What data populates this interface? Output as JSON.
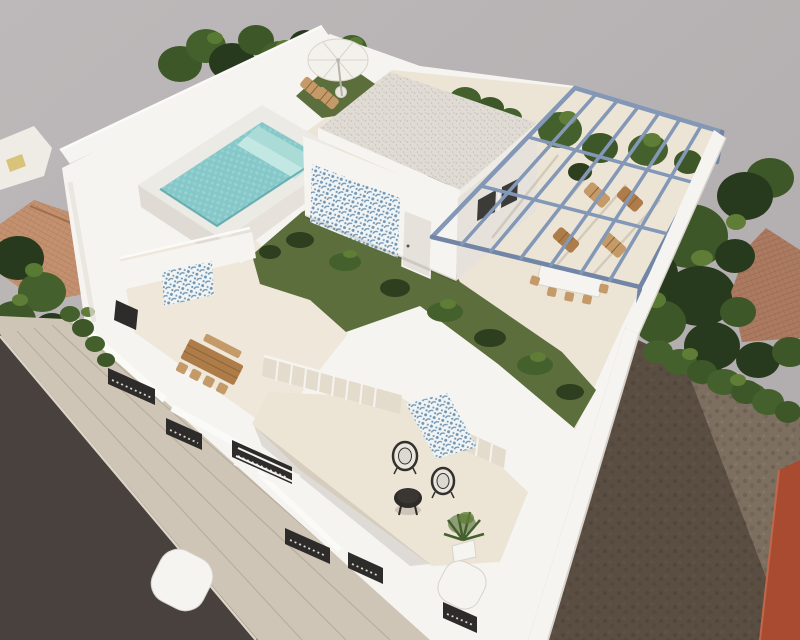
{
  "scene": {
    "type": "architectural-3d-render",
    "description": "Aerial axonometric 3D visualization of a modern two-storey white villa with rooftop pool, artificial lawn, blue steel pergola, terraces and surrounding plots",
    "elements": [
      "boundary-wall",
      "street-road",
      "sidewalk",
      "rooftop-pool",
      "pool-water",
      "pool-steps",
      "parasol",
      "sun-loungers",
      "rooftop-cabin",
      "azulejo-tile-panel",
      "cabin-door",
      "artificial-lawn",
      "tropical-plants",
      "steel-pergola",
      "wood-loungers",
      "pergola-dining-set",
      "middle-terrace",
      "wooden-dining-table",
      "lower-terrace",
      "outdoor-rug",
      "wire-chairs",
      "round-coffee-table",
      "potted-palm",
      "street-facade",
      "facade-windows",
      "balcony-railing",
      "curved-parapet",
      "right-boundary-wall",
      "neighbor-roof-left",
      "neighbor-roof-right",
      "trees",
      "hedge",
      "dirt-plot",
      "red-wall"
    ]
  },
  "colors": {
    "bg_top": "#bdb9ba",
    "bg_bottom": "#afaaab",
    "road": "#48413e",
    "sidewalk": "#cec5b6",
    "sidewalk_line": "#b4a996",
    "curb": "#ddd6c7",
    "white_lit": "#f6f4f0",
    "white_mid": "#efece6",
    "white_shade": "#e6e2db",
    "white_deep": "#d8d3cc",
    "floor_beige": "#ece4d5",
    "floor_beige2": "#efe7d9",
    "glass_beige": "#e3dbcc",
    "roof_base": "#e0dcd5",
    "roof_dot": "#c7c1b7",
    "pool_coping": "#eceae5",
    "pool_face": "#dfdbd4",
    "pool_water": "#86c8c9",
    "pool_water_light": "#a8dbd9",
    "pool_step1": "#aadbd7",
    "pool_step2": "#c3e8e3",
    "pool_rim": "#55a2a6",
    "lawn": "#5c6e3c",
    "lawn_light": "#75894a",
    "plant_dark": "#2e3f20",
    "plant_mid": "#44602c",
    "plant_light": "#5f7d36",
    "tree_dark": "#283a1d",
    "tree_mid": "#3d5728",
    "tree_light": "#587a33",
    "azulejo_bg": "#f2f4f4",
    "azulejo_blue": "#6f97b5",
    "pergola": "#8397b7",
    "pergola_dark": "#7185a6",
    "wood": "#ad7c49",
    "wood_light": "#c49a68",
    "wood_dark": "#8d6336",
    "terracotta_left": "#c39070",
    "terracotta_right": "#ab7a60",
    "dirt": "#7d6f60",
    "red_wall": "#a84b30",
    "red_wall_light": "#c1684a",
    "wire_dark": "#34302c",
    "cushion": "#e9e6e0",
    "umbrella": "#f3f1ec",
    "umbrella_line": "#d8d4cc",
    "table_black": "#2e2b28",
    "window_dark": "#2e2c2a",
    "window_tick": "#d8d3cb"
  }
}
